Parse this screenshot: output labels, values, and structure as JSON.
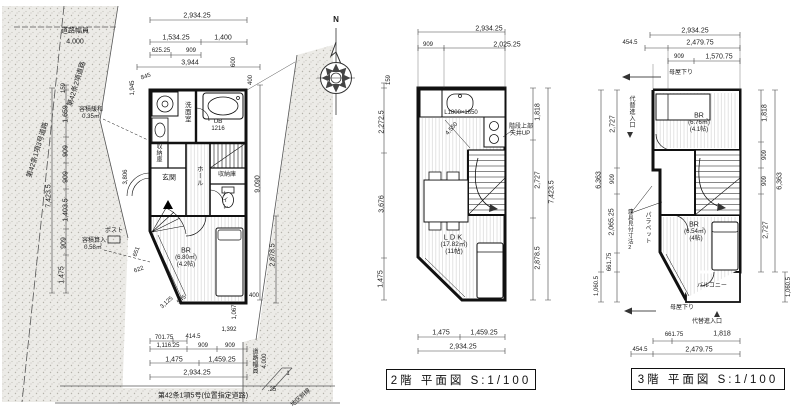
{
  "compass": {
    "north": "N"
  },
  "f1": {
    "site": {
      "road_w": "道路幅員",
      "road_wv": "4.000",
      "diag_left": "第42条1項3号道路",
      "diag_top": "第42条2項道路",
      "road_wb": "道路幅員",
      "road_wbv": "4.000",
      "designated": "第42条1項5号(位置指定道路)",
      "district": "地区斜線",
      "slope_rise": "1",
      "slope_run": ".25"
    },
    "notes": {
      "vol1": "容積緩和",
      "vol1v": "0.35㎡",
      "vol2": "容積算入",
      "vol2v": "0.58㎡",
      "post": "ポスト"
    },
    "rooms": {
      "wash": "洗面室",
      "ub": "UB",
      "ub_size": "1216",
      "sto1": "収納庫",
      "entry": "玄関",
      "hall": "ホール",
      "sto2": "収納庫",
      "wc": "トイレ",
      "br": "BR",
      "br_area": "(6.80㎡)",
      "br_tatami": "(4.2帖)"
    },
    "dims": {
      "top": [
        "2,934.25",
        "1,534.25",
        "1,400",
        "625.25",
        "909",
        "3,944",
        "600",
        "845",
        "1,945"
      ],
      "left": [
        "159",
        "1,659",
        "909",
        "909",
        "7,423.5",
        "1,403.5",
        "909",
        "1,475"
      ],
      "right": [
        "400",
        "9,090",
        "2,878.5",
        "1,067",
        "400",
        "1,392"
      ],
      "bottom": [
        "701.75",
        "414.5",
        "1,116.25",
        "909",
        "909",
        "1,475",
        "1,459.25",
        "2,934.25"
      ],
      "inner": [
        "651",
        "622",
        "3,125",
        "545",
        "3,806"
      ]
    }
  },
  "f2": {
    "dims": {
      "top": [
        "2,934.25",
        "909",
        "2,025.25"
      ],
      "left": [
        "159",
        "2,272.5",
        "3,676",
        "1,475"
      ],
      "right": [
        "1,818",
        "2,727",
        "2,878.5",
        "7,423.5"
      ],
      "bottom": [
        "1,475",
        "1,459.25",
        "2,934.25"
      ],
      "inner": [
        "4,550"
      ]
    },
    "notes": {
      "kitchen": "L1800×1650",
      "stair1": "階段上部",
      "stair2": "天井UP"
    },
    "rooms": {
      "ldk": "LDK",
      "ldk_area": "(17.82㎡)",
      "ldk_tatami": "(11帖)"
    },
    "caption": "2階 平面図 S:1/100"
  },
  "f3": {
    "dims": {
      "top": [
        "2,934.25",
        "454.5",
        "2,479.75",
        "909",
        "1,570.75"
      ],
      "left": [
        "2,727",
        "909",
        "2,065.25",
        "661.75",
        "6,363",
        "1,060.5"
      ],
      "right": [
        "1,818",
        "909",
        "909",
        "2,727",
        "6,363",
        "1,060.5"
      ],
      "bottom": [
        "661.75",
        "1,818",
        "454.5",
        "2,479.75"
      ]
    },
    "notes": {
      "roof1": "母屋下り",
      "roof2": "母屋下り",
      "alt1": "代替進入口",
      "alt2": "代替進入口",
      "fitting": "建具見付寸法2",
      "parapet": "パラペット"
    },
    "rooms": {
      "br1": "BR",
      "br1_area": "(6.76㎡)",
      "br1_tatami": "(4.1帖)",
      "br2": "BR",
      "br2_area": "(6.54㎡)",
      "br2_tatami": "(4帖)",
      "balcony": "バルコニー"
    },
    "caption": "3階 平面図 S:1/100"
  }
}
